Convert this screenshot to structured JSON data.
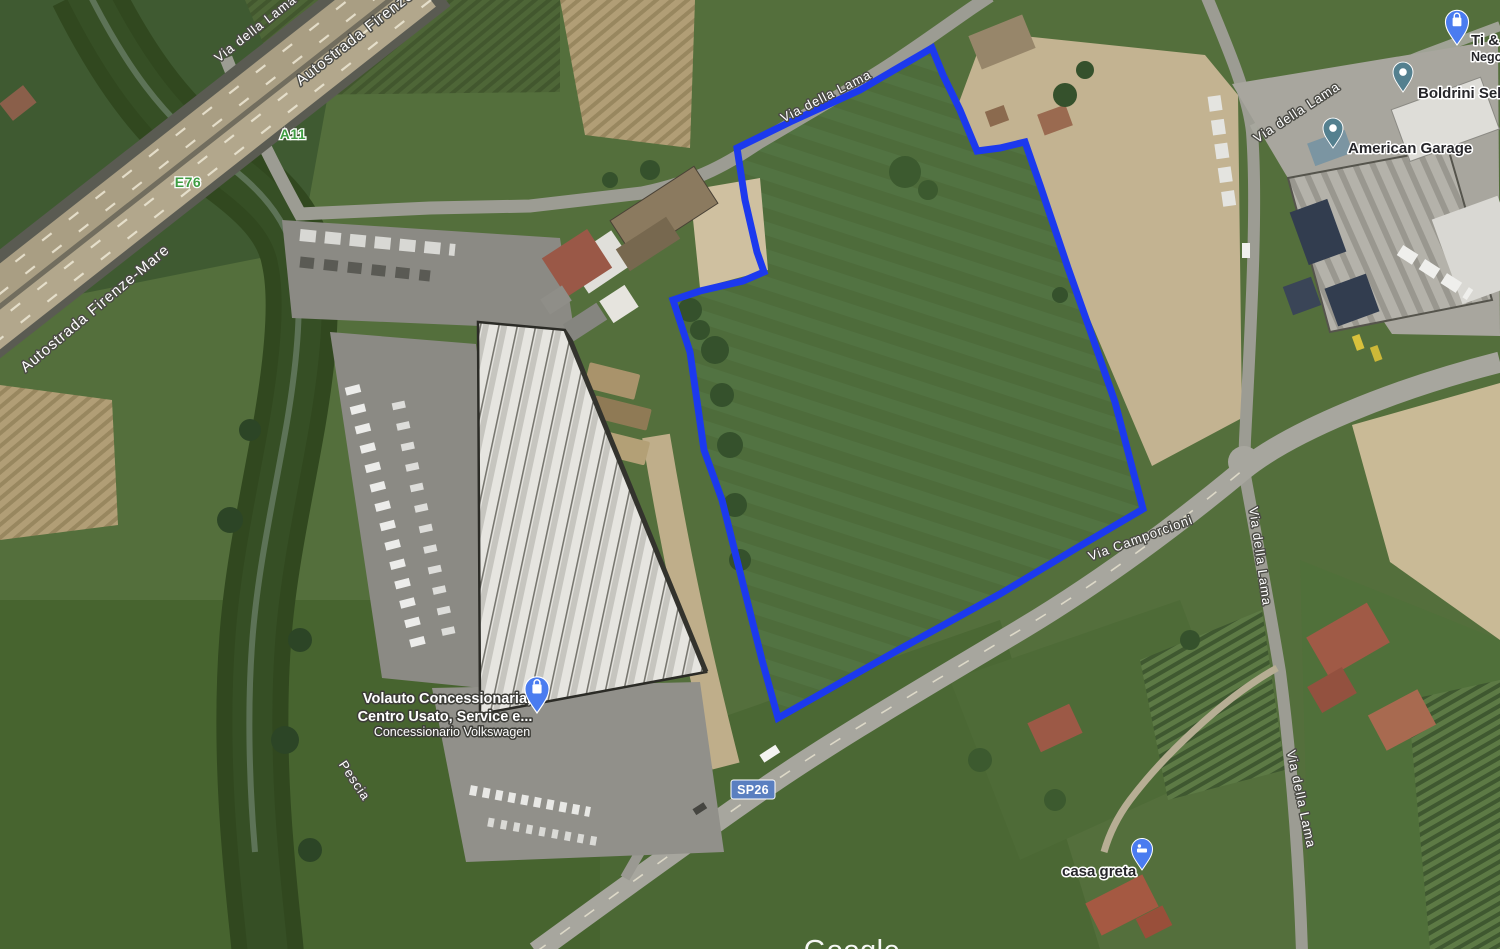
{
  "map_type": "satellite",
  "labels": {
    "via_della_lama": "Via della Lama",
    "autostrada_firenze_mare": "Autostrada Firenze-Mare",
    "via_camporcioni": "Via Camporcioni",
    "pescia_river": "Pescia"
  },
  "shields": {
    "a11": "A11",
    "e76": "E76",
    "sp26": "SP26"
  },
  "pois": {
    "volauto": {
      "line1": "Volauto Concessionaria,",
      "line2": "Centro Usato, Service e...",
      "line3": "Concessionario Volkswagen"
    },
    "american_garage": "American Garage",
    "boldrini": "Boldrini Selle",
    "ti_shop": {
      "line1": "Ti & I",
      "line2": "Negoz"
    },
    "casa_greta": "casa greta"
  },
  "colors": {
    "parcel_outline": "#1c39ee",
    "shield_green": "#3f9d42",
    "sp_badge_blue": "#5a7fc0",
    "pin_blue": "#4a7cf0",
    "pin_teal": "#54808f"
  },
  "watermark": "Google"
}
